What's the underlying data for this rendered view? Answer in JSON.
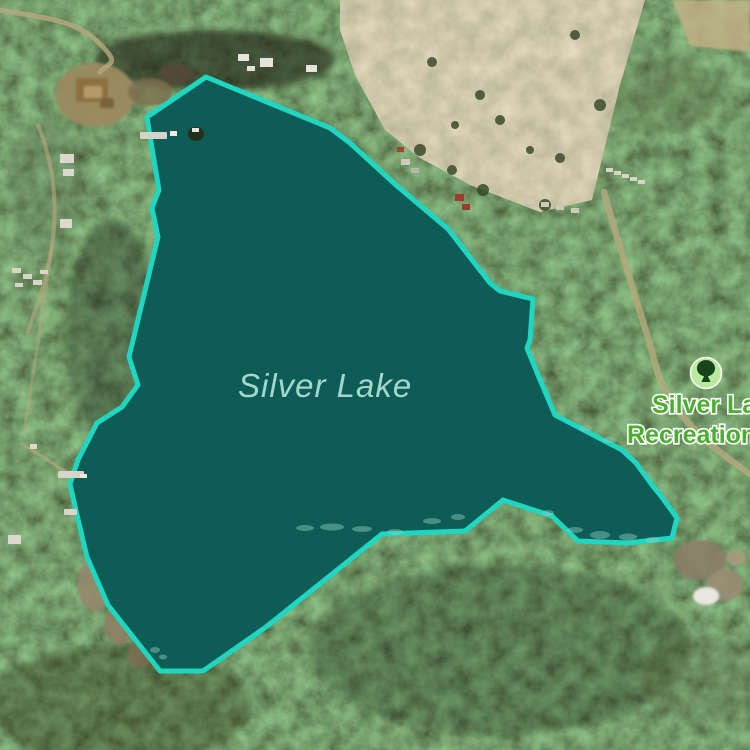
{
  "colors": {
    "lake_fill": "#0d5c55",
    "lake_outline": "#1fd7c1",
    "water_label": "#a3d6cf",
    "poi_label": "#4cae2f",
    "poi_icon_bg": "#b9eb9e",
    "poi_icon_glyph": "#17441a",
    "forest_base": "#2a4424"
  },
  "lake": {
    "name": "Silver Lake",
    "outline_points": "206,77 330,128 350,143 397,186 448,229 490,283 500,291 533,299 530,340 527,348 538,375 555,415 622,450 636,463 652,485 661,496 677,518 672,538 628,543 578,541 552,516 503,500 465,531 382,534 266,627 203,671 160,671 108,605 87,557 77,515 70,484 78,460 97,423 122,407 138,385 129,357 158,237 152,208 159,190 150,136 147,117"
  },
  "poi": {
    "line1": "Silver Lake",
    "line2": "Recreation Site",
    "icon": "park-tree-icon"
  }
}
